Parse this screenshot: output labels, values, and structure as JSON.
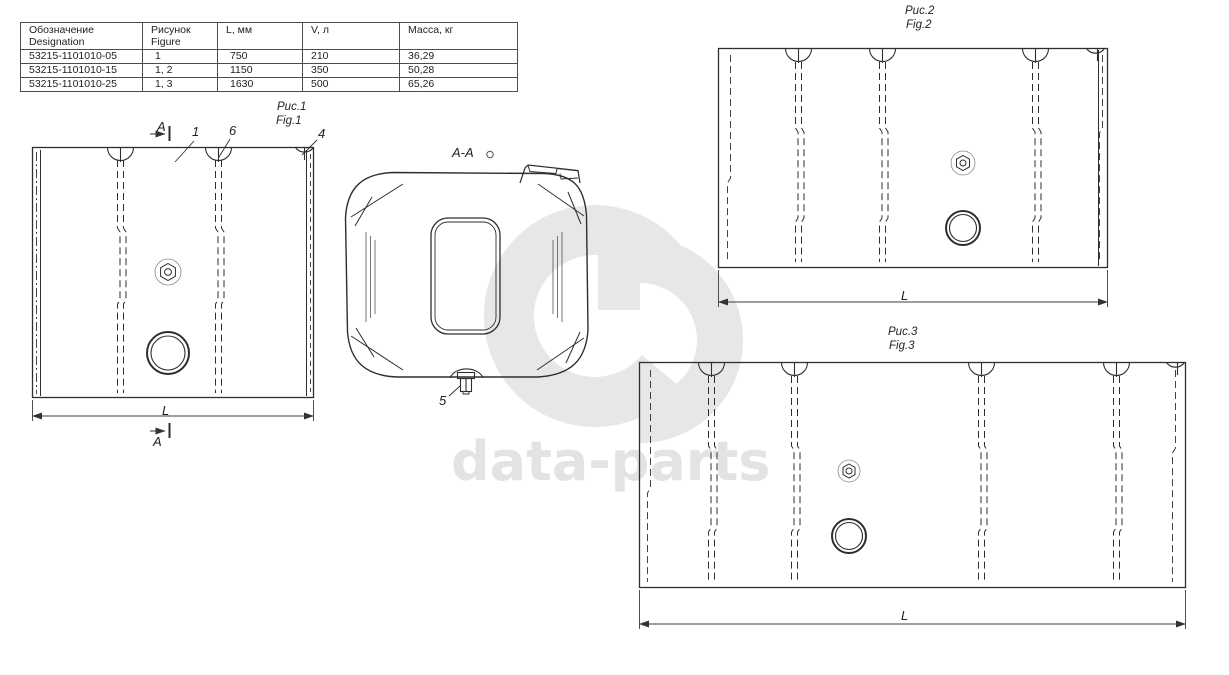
{
  "table": {
    "headers": [
      {
        "l1": "Обозначение",
        "l2": "Designation"
      },
      {
        "l1": "Рисунок",
        "l2": "Figure"
      },
      {
        "l1": "L, мм",
        "l2": ""
      },
      {
        "l1": "V, л",
        "l2": ""
      },
      {
        "l1": "Масса, кг",
        "l2": ""
      }
    ],
    "rows": [
      {
        "designation": "53215-1101010-05",
        "figure": "1",
        "l_mm": "750",
        "v_l": "210",
        "mass_kg": "36,29"
      },
      {
        "designation": "53215-1101010-15",
        "figure": "1, 2",
        "l_mm": "1150",
        "v_l": "350",
        "mass_kg": "50,28"
      },
      {
        "designation": "53215-1101010-25",
        "figure": "1, 3",
        "l_mm": "1630",
        "v_l": "500",
        "mass_kg": "65,26"
      }
    ]
  },
  "figures": {
    "fig1": {
      "label_ru": "Рис.1",
      "label_en": "Fig.1",
      "dim_label": "L",
      "section_mark_top": "A",
      "section_mark_bottom": "A",
      "callout_1": "1",
      "callout_6": "6",
      "callout_4": "4"
    },
    "section": {
      "label": "A-A",
      "callout_5": "5"
    },
    "fig2": {
      "label_ru": "Рис.2",
      "label_en": "Fig.2",
      "dim_label": "L"
    },
    "fig3": {
      "label_ru": "Рис.3",
      "label_en": "Fig.3",
      "dim_label": "L"
    }
  },
  "watermark": {
    "text": "data-parts"
  },
  "colors": {
    "line": "#2e2e2e",
    "dim": "#3c3c3c",
    "watermark": "#e7e7e7"
  }
}
